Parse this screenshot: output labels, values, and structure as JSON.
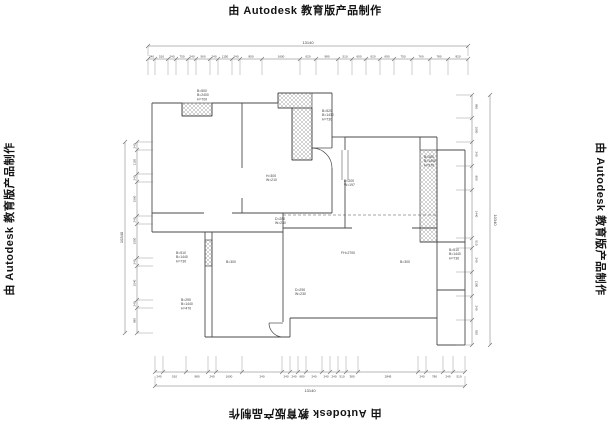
{
  "watermark": {
    "text": "由 Autodesk 教育版产品制作"
  },
  "plan": {
    "colors": {
      "line": "#4a4a4a",
      "dim": "#707070",
      "hatch": "#9a9a9a",
      "text": "#3c3c3c"
    },
    "walls": [
      [
        152,
        103,
        182,
        103
      ],
      [
        212,
        103,
        242,
        103
      ],
      [
        182,
        103,
        182,
        116
      ],
      [
        212,
        103,
        212,
        116
      ],
      [
        182,
        116,
        212,
        116
      ],
      [
        152,
        103,
        152,
        213
      ],
      [
        152,
        213,
        204,
        213
      ],
      [
        232,
        213,
        332,
        213
      ],
      [
        242,
        103,
        242,
        168
      ],
      [
        242,
        198,
        242,
        213
      ],
      [
        242,
        103,
        278,
        103
      ],
      [
        278,
        93,
        278,
        103
      ],
      [
        278,
        93,
        332,
        93
      ],
      [
        278,
        108,
        292,
        108
      ],
      [
        292,
        108,
        292,
        160
      ],
      [
        312,
        108,
        312,
        160
      ],
      [
        292,
        160,
        312,
        160
      ],
      [
        332,
        93,
        332,
        148
      ],
      [
        332,
        168,
        332,
        213
      ],
      [
        332,
        137,
        345,
        137
      ],
      [
        345,
        137,
        345,
        150
      ],
      [
        345,
        180,
        345,
        228
      ],
      [
        345,
        137,
        420,
        137
      ],
      [
        420,
        137,
        437,
        137
      ],
      [
        420,
        137,
        420,
        150
      ],
      [
        437,
        137,
        437,
        150
      ],
      [
        420,
        242,
        437,
        242
      ],
      [
        437,
        150,
        437,
        318
      ],
      [
        437,
        150,
        465,
        150
      ],
      [
        465,
        150,
        465,
        345
      ],
      [
        437,
        242,
        465,
        242
      ],
      [
        437,
        290,
        465,
        290
      ],
      [
        437,
        345,
        465,
        345
      ],
      [
        437,
        318,
        437,
        345
      ],
      [
        283,
        228,
        352,
        228
      ],
      [
        412,
        228,
        437,
        228
      ],
      [
        283,
        213,
        283,
        232
      ],
      [
        152,
        213,
        152,
        232
      ],
      [
        152,
        232,
        205,
        232
      ],
      [
        205,
        232,
        283,
        232
      ],
      [
        205,
        232,
        205,
        337
      ],
      [
        212,
        232,
        212,
        337
      ],
      [
        205,
        337,
        290,
        337
      ],
      [
        283,
        232,
        283,
        322
      ],
      [
        290,
        318,
        437,
        318
      ],
      [
        290,
        318,
        290,
        337
      ]
    ],
    "dashed": [
      [
        283,
        215,
        437,
        215
      ]
    ],
    "hatches": [
      [
        182,
        103,
        30,
        13
      ],
      [
        278,
        93,
        34,
        15
      ],
      [
        292,
        108,
        20,
        52
      ],
      [
        420,
        150,
        17,
        92
      ],
      [
        205,
        240,
        7,
        26
      ]
    ],
    "windows": [
      [
        342,
        150,
        342,
        180
      ],
      [
        348,
        150,
        348,
        180
      ]
    ],
    "arcs": [
      {
        "d": "M312,148 A20,20 0 0 1 332,168",
        "leaf": [
          332,
          148,
          312,
          148
        ]
      },
      {
        "d": "M269,323 A14,14 0 0 0 283,337",
        "leaf": [
          283,
          323,
          269,
          323
        ]
      }
    ],
    "labels": [
      {
        "x": 197,
        "y": 92,
        "lines": [
          "B=500",
          "B=2400",
          "H=700"
        ]
      },
      {
        "x": 322,
        "y": 112,
        "lines": [
          "B=520",
          "B=1430",
          "H=730"
        ]
      },
      {
        "x": 424,
        "y": 158,
        "lines": [
          "B=280",
          "B=1440",
          "H=270"
        ]
      },
      {
        "x": 449,
        "y": 251,
        "lines": [
          "B=510",
          "B=1440",
          "H=730"
        ]
      },
      {
        "x": 176,
        "y": 254,
        "lines": [
          "B=510",
          "B=1440",
          "H=730"
        ]
      },
      {
        "x": 181,
        "y": 301,
        "lines": [
          "B=290",
          "B=1440",
          "H=470"
        ]
      },
      {
        "x": 266,
        "y": 177,
        "lines": [
          "H=300",
          "W=210"
        ]
      },
      {
        "x": 344,
        "y": 182,
        "lines": [
          "D=200",
          "W=197"
        ]
      },
      {
        "x": 275,
        "y": 220,
        "lines": [
          "D=280",
          "W=230"
        ]
      },
      {
        "x": 295,
        "y": 291,
        "lines": [
          "D=290",
          "W=230"
        ]
      },
      {
        "x": 400,
        "y": 263,
        "lines": [
          "B=300"
        ]
      },
      {
        "x": 226,
        "y": 263,
        "lines": [
          "B=300"
        ]
      },
      {
        "x": 341,
        "y": 254,
        "lines": [
          "FH=2700"
        ]
      }
    ],
    "dims": {
      "top_overall": {
        "y": 46,
        "x1": 148,
        "x2": 468,
        "label": "13140"
      },
      "top_chain": {
        "y": 59,
        "ticks": [
          148,
          155,
          168,
          176,
          188,
          196,
          210,
          218,
          232,
          240,
          262,
          300,
          316,
          338,
          352,
          366,
          380,
          394,
          412,
          430,
          448,
          468
        ],
        "values": [
          "240",
          "510",
          "240",
          "750",
          "240",
          "560",
          "240",
          "1150",
          "240",
          "850",
          "1600",
          "620",
          "980",
          "510",
          "600",
          "620",
          "690",
          "750",
          "760",
          "780",
          "820"
        ]
      },
      "bottom_chain": {
        "y": 372,
        "ticks": [
          155,
          163,
          186,
          208,
          216,
          242,
          282,
          290,
          298,
          306,
          322,
          330,
          338,
          346,
          358,
          418,
          426,
          443,
          453,
          465
        ],
        "values": [
          "240",
          "510",
          "980",
          "240",
          "1600",
          "240",
          "240",
          "240",
          "680",
          "240",
          "240",
          "240",
          "510",
          "380",
          "2845",
          "240",
          "780",
          "240",
          "510"
        ]
      },
      "bottom_overall": {
        "y": 386,
        "x1": 155,
        "x2": 465,
        "label": "13140"
      },
      "left_chain": {
        "x": 137,
        "ticks": [
          142,
          150,
          174,
          182,
          216,
          224,
          258,
          266,
          300,
          308,
          333
        ],
        "values": [
          "240",
          "1120",
          "240",
          "1560",
          "240",
          "1550",
          "240",
          "1540",
          "240",
          "980"
        ]
      },
      "left_overall": {
        "x": 125,
        "y1": 142,
        "y2": 333,
        "label": "10340"
      },
      "right_chain": {
        "x": 472,
        "ticks": [
          95,
          118,
          142,
          166,
          190,
          238,
          248,
          272,
          296,
          320,
          345
        ],
        "values": [
          "980",
          "1080",
          "240",
          "980",
          "1440",
          "510",
          "240",
          "1100",
          "240",
          "820"
        ]
      },
      "right_overall": {
        "x": 490,
        "y1": 95,
        "y2": 345,
        "label": "10340"
      }
    }
  }
}
